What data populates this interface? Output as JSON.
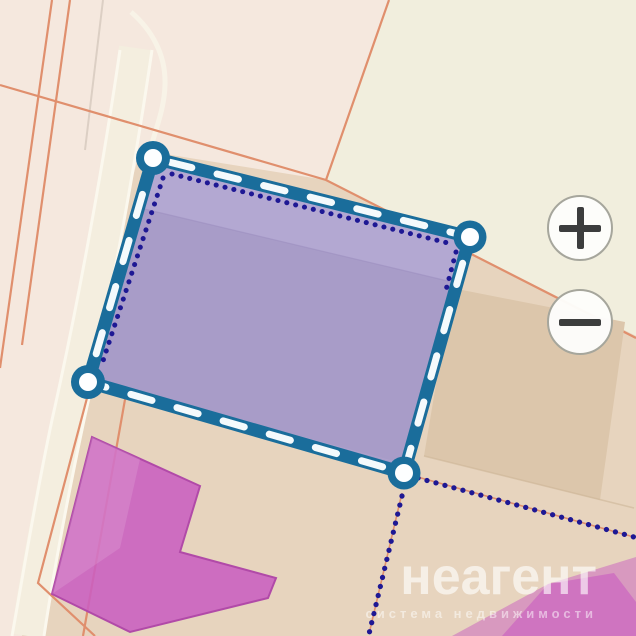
{
  "watermark": {
    "brand": "неагент",
    "tagline": "система недвижимости"
  },
  "zoom_controls": {
    "zoom_in_icon": "plus-icon",
    "zoom_out_icon": "minus-icon"
  },
  "selection": {
    "type": "parcel-polygon-selection",
    "vertex_count": 4,
    "vertices": [
      [
        153,
        158
      ],
      [
        470,
        237
      ],
      [
        404,
        473
      ],
      [
        88,
        382
      ]
    ]
  },
  "colors": {
    "map_pink": "#f5e8de",
    "map_cream": "#f1eedd",
    "map_tan": "#e7d4be",
    "building_tan": "#dcc6ab",
    "road_fill": "#f4eedf",
    "parcel_line": "#e08f6d",
    "selection_fill": "#a89cc8",
    "selection_fill_light": "#b5aad4",
    "selection_border": "#1a6d9b",
    "selection_dash": "#f4fafc",
    "boundary_dots": "#1e1894",
    "building_magenta": "#c95ec0"
  }
}
